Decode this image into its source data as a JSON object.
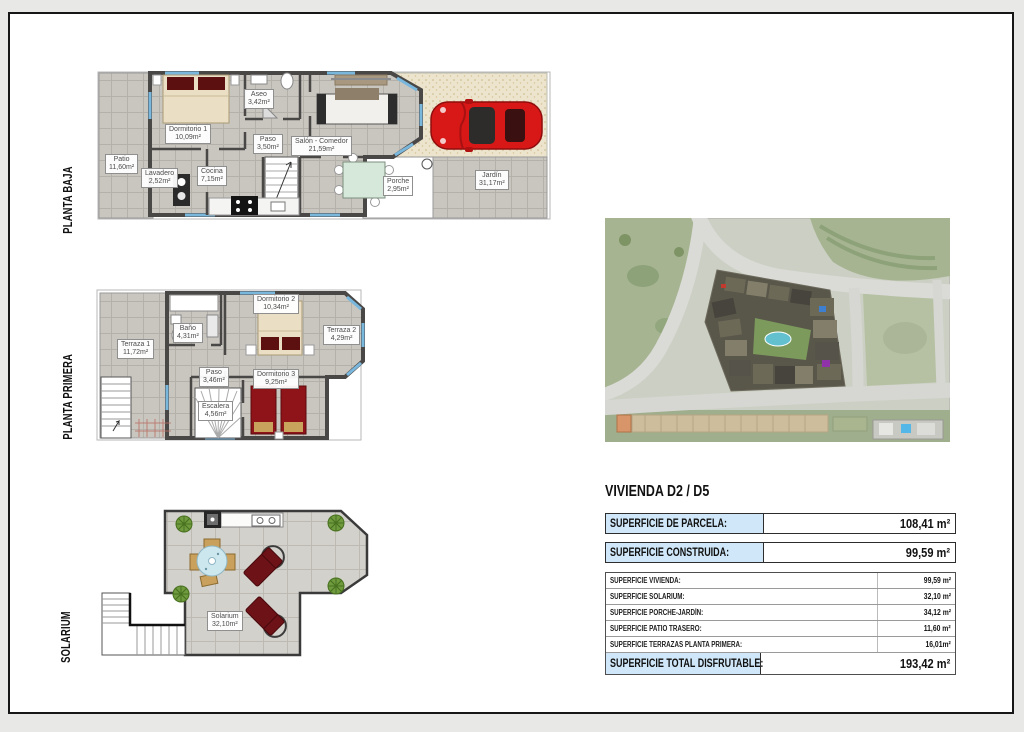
{
  "doc": {
    "floors": [
      {
        "label": "PLANTA BAJA",
        "rooms": [
          {
            "name": "Dormitorio 1",
            "area": "10,09m²"
          },
          {
            "name": "Aseo",
            "area": "3,42m²"
          },
          {
            "name": "Paso",
            "area": "3,50m²"
          },
          {
            "name": "Salón - Comedor",
            "area": "21,59m²"
          },
          {
            "name": "Patio",
            "area": "11,60m²"
          },
          {
            "name": "Lavadero",
            "area": "2,52m²"
          },
          {
            "name": "Cocina",
            "area": "7,15m²"
          },
          {
            "name": "Porche",
            "area": "2,95m²"
          },
          {
            "name": "Jardín",
            "area": "31,17m²"
          }
        ]
      },
      {
        "label": "PLANTA PRIMERA",
        "rooms": [
          {
            "name": "Terraza 1",
            "area": "11,72m²"
          },
          {
            "name": "Baño",
            "area": "4,31m²"
          },
          {
            "name": "Dormitorio 2",
            "area": "10,34m²"
          },
          {
            "name": "Terraza 2",
            "area": "4,29m²"
          },
          {
            "name": "Paso",
            "area": "3,46m²"
          },
          {
            "name": "Escalera",
            "area": "4,56m²"
          },
          {
            "name": "Dormitorio 3",
            "area": "9,25m²"
          }
        ]
      },
      {
        "label": "SOLARIUM",
        "rooms": [
          {
            "name": "Solarium",
            "area": "32,10m²"
          }
        ]
      }
    ],
    "summary": {
      "title": "VIVIENDA D2 / D5",
      "parcela": {
        "label": "SUPERFICIE DE PARCELA:",
        "value": "108,41 m²"
      },
      "construida": {
        "label": "SUPERFICIE CONSTRUIDA:",
        "value": "99,59 m²"
      },
      "details": [
        {
          "label": "SUPERFICIE VIVIENDA:",
          "value": "99,59 m²"
        },
        {
          "label": "SUPERFICIE SOLARIUM:",
          "value": "32,10 m²"
        },
        {
          "label": "SUPERFICIE PORCHE-JARDÍN:",
          "value": "34,12 m²"
        },
        {
          "label": "SUPERFICIE PATIO TRASERO:",
          "value": "11,60 m²"
        },
        {
          "label": "SUPERFICIE TERRAZAS PLANTA PRIMERA:",
          "value": "16,01m²"
        }
      ],
      "total": {
        "label": "SUPERFICIE TOTAL DISFRUTABLE:",
        "value": "193,42 m²"
      }
    },
    "colors": {
      "highlight_blue": "#cfe7f8",
      "wall_dark": "#4a4846",
      "car_red": "#d81717",
      "bed_red": "#8e1419",
      "tile_gray": "#c9c6c0"
    }
  }
}
